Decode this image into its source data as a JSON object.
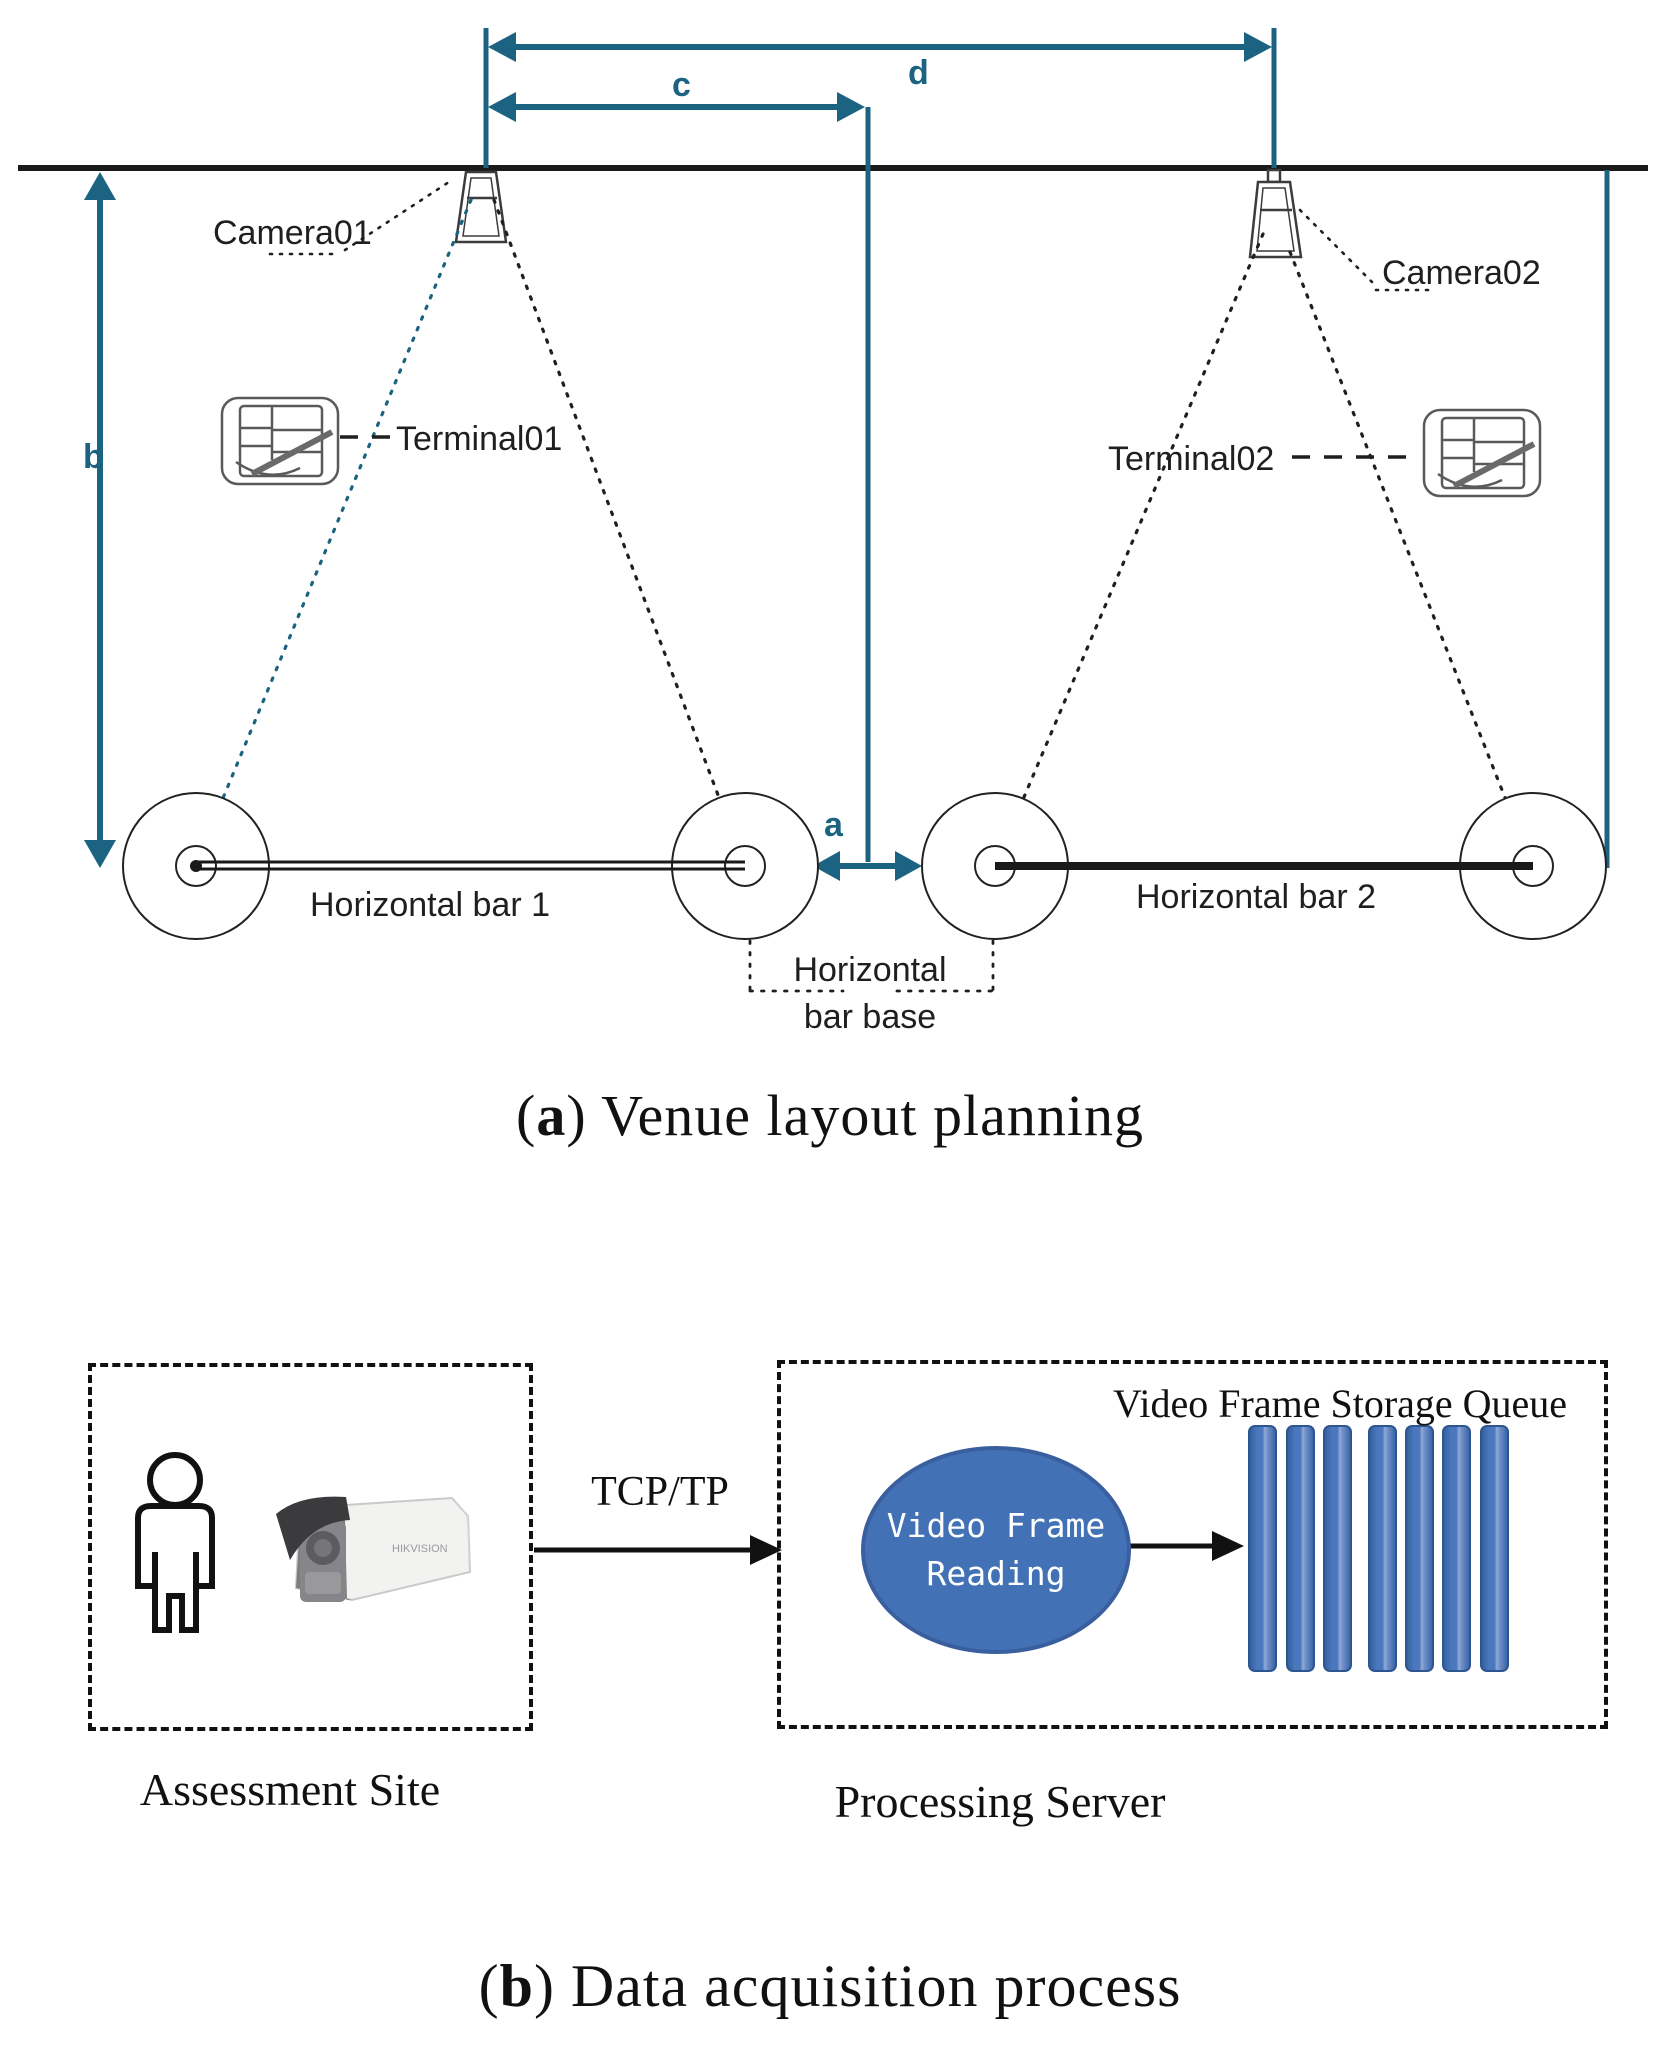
{
  "colors": {
    "teal": "#1b6380",
    "line_black": "#1a1a1a",
    "ellipse_fill": "#4271b6",
    "ellipse_border": "#3a5f9e",
    "queue_bar_fill": "#4a77bd",
    "queue_bar_border": "#2d5590"
  },
  "part_a": {
    "caption": {
      "open": "(",
      "letter": "a",
      "rest": ") Venue layout planning"
    },
    "dims": {
      "a": "a",
      "b": "b",
      "c": "c",
      "d": "d"
    },
    "camera1_label": "Camera01",
    "camera2_label": "Camera02",
    "terminal1_label": "Terminal01",
    "terminal2_label": "Terminal02",
    "bar1_label": "Horizontal bar 1",
    "bar2_label": "Horizontal bar 2",
    "base_label_line1": "Horizontal",
    "base_label_line2": "bar base"
  },
  "part_b": {
    "caption": {
      "open": "(",
      "letter": "b",
      "rest": ") Data acquisition process"
    },
    "assessment_label": "Assessment Site",
    "processing_label": "Processing Server",
    "tcp_label": "TCP/TP",
    "queue_label": "Video Frame Storage Queue",
    "ellipse_line1": "Video Frame",
    "ellipse_line2": "Reading",
    "camera_brand": "HIKVISION"
  }
}
